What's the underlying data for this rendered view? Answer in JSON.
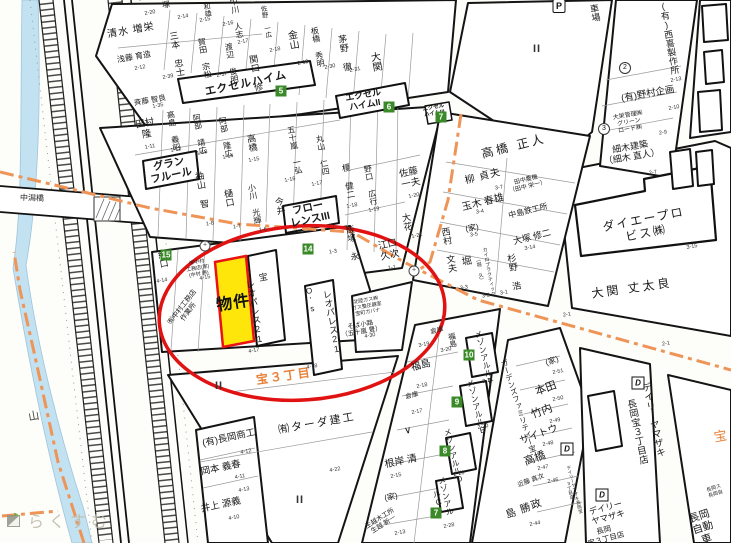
{
  "map": {
    "colors": {
      "highlight_fill": "#ffe60a",
      "highlight_stroke": "#e81313",
      "circle_red": "#e11212",
      "boundary_orange": "#ef9457",
      "district_orange": "#e8823a",
      "water_blue": "#c2e2f2",
      "building_number_green": "#3a8a28",
      "watermark_gray": "#bdb9a9"
    },
    "watermark": {
      "text": "らくすむ"
    },
    "bridge": {
      "label": "中潟橋"
    },
    "highlight": {
      "label": "物件"
    },
    "name_labels": [
      {
        "t": "塚",
        "x": 166,
        "y": 5,
        "s": 8
      },
      {
        "t": "和雄",
        "x": 207,
        "y": 10,
        "s": 7,
        "v": 1
      },
      {
        "t": "中川 人志",
        "x": 236,
        "y": 18,
        "s": 8,
        "v": 1
      },
      {
        "t": "佐野 一広",
        "x": 264,
        "y": 22,
        "s": 6.5,
        "v": 1
      },
      {
        "t": "清水 増栄",
        "x": 131,
        "y": 31,
        "s": 10,
        "ls": 1
      },
      {
        "t": "浅藤 育造",
        "x": 134,
        "y": 57,
        "s": 8
      },
      {
        "t": "三本 忠士",
        "x": 176,
        "y": 54,
        "s": 9,
        "v": 1
      },
      {
        "t": "賀田 宗松",
        "x": 204,
        "y": 58,
        "s": 8,
        "v": 1
      },
      {
        "t": "渡辺 俊明",
        "x": 231,
        "y": 63,
        "s": 8,
        "v": 1
      },
      {
        "t": "関口 修",
        "x": 255,
        "y": 73,
        "s": 9,
        "v": 1
      },
      {
        "t": "金山",
        "x": 291,
        "y": 40,
        "s": 10,
        "v": 1
      },
      {
        "t": "板橋 秀明",
        "x": 317,
        "y": 47,
        "s": 8,
        "v": 1
      },
      {
        "t": "茅野 徹",
        "x": 344,
        "y": 53,
        "s": 9,
        "v": 1
      },
      {
        "t": "大関",
        "x": 374,
        "y": 62,
        "s": 10,
        "v": 1
      },
      {
        "t": "エクセルハイム",
        "x": 246,
        "y": 84,
        "r": -12,
        "s": 11,
        "b": 1,
        "ls": 1
      },
      {
        "t": "エクセル\nハイムII",
        "x": 364,
        "y": 100,
        "s": 9,
        "b": 1
      },
      {
        "t": "エクセル\nハイムIII",
        "x": 434,
        "y": 111,
        "s": 5.5,
        "b": 1
      },
      {
        "t": "車場",
        "x": 594,
        "y": 13,
        "s": 9,
        "v": 1
      },
      {
        "t": "(有)西喜製作所",
        "x": 668,
        "y": 38,
        "s": 9,
        "v": 1
      },
      {
        "t": "(有)野村企画",
        "x": 648,
        "y": 95,
        "s": 9.5
      },
      {
        "t": "大栄管理㈱\nグリーン\nロード㈱",
        "x": 629,
        "y": 123,
        "s": 6
      },
      {
        "t": "細木建築\n（細木 直人）",
        "x": 631,
        "y": 152,
        "s": 9
      },
      {
        "t": "高橋 正人",
        "x": 514,
        "y": 147,
        "r": -14,
        "s": 12,
        "ls": 3
      },
      {
        "t": "柳 貞夫",
        "x": 483,
        "y": 177,
        "r": -14,
        "s": 10,
        "ls": 1
      },
      {
        "t": "田中農機\n（田中 栄一）",
        "x": 527,
        "y": 184,
        "r": -14,
        "s": 6
      },
      {
        "t": "玉木 春雄",
        "x": 483,
        "y": 203,
        "r": -14,
        "s": 10
      },
      {
        "t": "中島鉄工所",
        "x": 528,
        "y": 211,
        "r": -14,
        "s": 8
      },
      {
        "t": "(家)",
        "x": 472,
        "y": 228,
        "s": 8
      },
      {
        "t": "大塚 修二",
        "x": 532,
        "y": 237,
        "r": -14,
        "s": 9
      },
      {
        "t": "堀",
        "x": 467,
        "y": 262,
        "s": 10
      },
      {
        "t": "カイロプラクティック",
        "x": 488,
        "y": 272,
        "s": 5,
        "v": 1
      },
      {
        "t": "（堀 久）",
        "x": 479,
        "y": 270,
        "s": 5,
        "v": 1
      },
      {
        "t": "杉野 浩",
        "x": 513,
        "y": 272,
        "s": 9,
        "v": 1
      },
      {
        "t": "西村 文夫",
        "x": 448,
        "y": 250,
        "s": 9,
        "v": 1
      },
      {
        "t": "ダイエープロビス㈱",
        "x": 645,
        "y": 227,
        "r": -11,
        "s": 12,
        "ls": 2
      },
      {
        "t": "大関 丈太良",
        "x": 632,
        "y": 289,
        "r": -8,
        "s": 12,
        "ls": 3
      },
      {
        "t": "斉藤 智良",
        "x": 150,
        "y": 101,
        "s": 7.5
      },
      {
        "t": "田村\n隆",
        "x": 146,
        "y": 130,
        "s": 9.5
      },
      {
        "t": "高島 義昭",
        "x": 173,
        "y": 131,
        "s": 8,
        "v": 1
      },
      {
        "t": "阿部 靖広",
        "x": 199,
        "y": 134,
        "s": 8,
        "v": 1
      },
      {
        "t": "阿部 隆広",
        "x": 225,
        "y": 137,
        "s": 8,
        "v": 1
      },
      {
        "t": "高橋",
        "x": 251,
        "y": 143,
        "s": 9,
        "v": 1
      },
      {
        "t": "五十嵐 一弘",
        "x": 294,
        "y": 150,
        "s": 8,
        "v": 1
      },
      {
        "t": "丸山 仁四",
        "x": 322,
        "y": 155,
        "s": 8,
        "v": 1
      },
      {
        "t": "榎 健二",
        "x": 348,
        "y": 181,
        "s": 8.5,
        "v": 1
      },
      {
        "t": "袖山 智",
        "x": 201,
        "y": 190,
        "s": 9,
        "v": 1
      },
      {
        "t": "樋口",
        "x": 228,
        "y": 198,
        "s": 9,
        "v": 1
      },
      {
        "t": "小川 光輝",
        "x": 254,
        "y": 204,
        "s": 8,
        "v": 1
      },
      {
        "t": "今井",
        "x": 279,
        "y": 206,
        "s": 9,
        "v": 1
      },
      {
        "t": "グラン\nフルール",
        "x": 170,
        "y": 170,
        "r": -12,
        "s": 10.5,
        "b": 1
      },
      {
        "t": "フロー\nレンスIII",
        "x": 309,
        "y": 214,
        "r": -12,
        "s": 10.5,
        "b": 1
      },
      {
        "t": "野口 広行",
        "x": 370,
        "y": 185,
        "s": 8,
        "v": 1
      },
      {
        "t": "佐藤\n一夫",
        "x": 410,
        "y": 179,
        "r": -12,
        "s": 9.5
      },
      {
        "t": "大花",
        "x": 406,
        "y": 222,
        "s": 9,
        "v": 1
      },
      {
        "t": "飯塚 永",
        "x": 352,
        "y": 243,
        "s": 8.5,
        "v": 1
      },
      {
        "t": "江口\n久次",
        "x": 389,
        "y": 251,
        "r": -12,
        "s": 9.5
      },
      {
        "t": "紀口",
        "x": 162,
        "y": 259,
        "s": 9,
        "v": 1
      },
      {
        "t": "㈲中村\n工務店(家)\n(中村 勝)",
        "x": 198,
        "y": 269,
        "s": 5
      },
      {
        "t": "㈲中村工務店\n作業所",
        "x": 186,
        "y": 310,
        "r": -52,
        "s": 7
      },
      {
        "t": "宝",
        "x": 262,
        "y": 277,
        "s": 9,
        "v": 1
      },
      {
        "t": "レオパレス21",
        "x": 254,
        "y": 312,
        "s": 9,
        "v": 1
      },
      {
        "t": "O's",
        "x": 310,
        "y": 300,
        "s": 8,
        "v": 1
      },
      {
        "t": "レオパレス21",
        "x": 331,
        "y": 322,
        "s": 9,
        "v": 1
      },
      {
        "t": "宝３丁目",
        "x": 284,
        "y": 377,
        "r": -8,
        "s": 12,
        "c": "#e8823a",
        "b": 1,
        "ls": 2,
        "n": "district-label"
      },
      {
        "t": "㈲ターダ建工",
        "x": 317,
        "y": 424,
        "s": 11,
        "ls": 2
      },
      {
        "t": "(有)長岡商工",
        "x": 229,
        "y": 439,
        "r": -12,
        "s": 9.5
      },
      {
        "t": "岡本 義春",
        "x": 221,
        "y": 469,
        "r": -12,
        "s": 9.5
      },
      {
        "t": "井上 源義",
        "x": 221,
        "y": 506,
        "r": -12,
        "s": 9.5
      },
      {
        "t": "北陸ガス㈱\nガス整圧器室\n宝町ガバナ",
        "x": 367,
        "y": 307,
        "s": 5
      },
      {
        "t": "そば小路\n（五十嵐 豊）",
        "x": 361,
        "y": 329,
        "s": 6.5
      },
      {
        "t": "倉庫",
        "x": 437,
        "y": 331,
        "r": -12,
        "s": 6.5
      },
      {
        "t": "福島",
        "x": 452,
        "y": 340,
        "s": 7.5,
        "v": 1
      },
      {
        "t": "福島",
        "x": 421,
        "y": 366,
        "r": -14,
        "s": 10
      },
      {
        "t": "倉庫",
        "x": 412,
        "y": 396,
        "r": -12,
        "s": 6.5
      },
      {
        "t": "∨",
        "x": 408,
        "y": 431,
        "s": 10
      },
      {
        "t": "根岸 清",
        "x": 401,
        "y": 462,
        "r": -12,
        "s": 10
      },
      {
        "t": "(家)",
        "x": 391,
        "y": 497,
        "r": -12,
        "s": 8
      },
      {
        "t": "生越木工所\n生越 新一",
        "x": 382,
        "y": 522,
        "r": -32,
        "s": 6.5
      },
      {
        "t": "メゾンアルルF",
        "x": 484,
        "y": 358,
        "r": -14,
        "s": 8,
        "v": 1
      },
      {
        "t": "メゾンアルルE",
        "x": 476,
        "y": 407,
        "r": -14,
        "s": 8,
        "v": 1
      },
      {
        "t": "メゾンアルルD",
        "x": 453,
        "y": 456,
        "r": -14,
        "s": 8,
        "v": 1
      },
      {
        "t": "メゾンアルルC",
        "x": 441,
        "y": 497,
        "r": -14,
        "s": 8,
        "v": 1
      },
      {
        "t": "ガーデンズファミリティー宝",
        "x": 518,
        "y": 406,
        "r": -18,
        "s": 7.5,
        "v": 1
      },
      {
        "t": "(家)",
        "x": 552,
        "y": 361,
        "r": -20,
        "s": 8
      },
      {
        "t": "本田",
        "x": 546,
        "y": 389,
        "r": -20,
        "s": 11
      },
      {
        "t": "竹内",
        "x": 542,
        "y": 412,
        "r": -20,
        "s": 11
      },
      {
        "t": "サイトウ",
        "x": 539,
        "y": 435,
        "r": -20,
        "s": 10
      },
      {
        "t": "高橋",
        "x": 535,
        "y": 459,
        "r": -20,
        "s": 11
      },
      {
        "t": "近藤 真次",
        "x": 531,
        "y": 481,
        "r": -20,
        "s": 6.5
      },
      {
        "t": "島 勝政",
        "x": 524,
        "y": 509,
        "r": -20,
        "s": 10.5,
        "ls": 1
      },
      {
        "t": "デイリーヤマザキ",
        "x": 652,
        "y": 420,
        "r": -12,
        "s": 9.5,
        "v": 1
      },
      {
        "t": "長岡宝３丁目店",
        "x": 636,
        "y": 432,
        "r": -12,
        "s": 9.5,
        "v": 1
      },
      {
        "t": "デイリーヤマザキ長岡宝3丁目店",
        "x": 572,
        "y": 490,
        "r": -15,
        "s": 4.5,
        "v": 1
      },
      {
        "t": "デイリー\nヤマザキ",
        "x": 607,
        "y": 513,
        "r": -15,
        "s": 8.5
      },
      {
        "t": "長岡\n宝３丁目店",
        "x": 605,
        "y": 535,
        "r": -15,
        "s": 7.5
      },
      {
        "t": "長岡自動車",
        "x": 703,
        "y": 528,
        "r": -18,
        "s": 10.5
      },
      {
        "t": "長岡ス\n長岡自",
        "x": 715,
        "y": 492,
        "r": -18,
        "s": 5
      },
      {
        "t": "宝",
        "x": 719,
        "y": 436,
        "s": 13,
        "c": "#e8823a",
        "v": 1,
        "n": "district-label"
      },
      {
        "t": "山",
        "x": 34,
        "y": 417,
        "s": 11,
        "c": "#444"
      }
    ],
    "empty_lot_marks": [
      {
        "x": 537,
        "y": 49
      },
      {
        "x": 219,
        "y": 386
      },
      {
        "x": 300,
        "y": 500
      }
    ],
    "building_numbers": [
      {
        "n": "5",
        "x": 281,
        "y": 91
      },
      {
        "n": "6",
        "x": 389,
        "y": 107
      },
      {
        "n": "7",
        "x": 441,
        "y": 117
      },
      {
        "n": "14",
        "x": 308,
        "y": 249
      },
      {
        "n": "15",
        "x": 166,
        "y": 255
      },
      {
        "n": "10",
        "x": 469,
        "y": 355
      },
      {
        "n": "9",
        "x": 457,
        "y": 402
      },
      {
        "n": "8",
        "x": 445,
        "y": 451
      },
      {
        "n": "7",
        "x": 436,
        "y": 513
      }
    ],
    "symbols": [
      {
        "k": "P",
        "t": "P",
        "x": 559,
        "y": 6,
        "n": "parking-icon"
      },
      {
        "k": "D",
        "t": "D",
        "x": 638,
        "y": 383,
        "n": "daily-yamazaki-icon"
      },
      {
        "k": "D",
        "t": "D",
        "x": 567,
        "y": 449,
        "n": "daily-yamazaki-icon"
      },
      {
        "k": "D",
        "t": "D",
        "x": 602,
        "y": 495,
        "n": "daily-yamazaki-icon"
      },
      {
        "k": "c",
        "t": "2",
        "x": 625,
        "y": 68,
        "n": "circled-number"
      },
      {
        "k": "c",
        "t": "3",
        "x": 604,
        "y": 129,
        "n": "circled-number"
      },
      {
        "k": "m",
        "t": "+",
        "x": 205,
        "y": 246,
        "n": "utility-mark"
      },
      {
        "k": "m",
        "t": "+",
        "x": 414,
        "y": 271,
        "n": "utility-mark"
      }
    ],
    "parcel_numbers": [
      {
        "n": "2-20",
        "x": 150,
        "y": 13
      },
      {
        "n": "2-14",
        "x": 183,
        "y": 17
      },
      {
        "n": "2-15",
        "x": 205,
        "y": 20
      },
      {
        "n": "2-16",
        "x": 228,
        "y": 24
      },
      {
        "n": "2-17",
        "x": 243,
        "y": 42
      },
      {
        "n": "2-18",
        "x": 275,
        "y": 50
      },
      {
        "n": "2-19",
        "x": 303,
        "y": 63
      },
      {
        "n": "2-30",
        "x": 330,
        "y": 67
      },
      {
        "n": "2-31",
        "x": 355,
        "y": 70
      },
      {
        "n": "2-12",
        "x": 140,
        "y": 68
      },
      {
        "n": "2-39",
        "x": 168,
        "y": 77
      },
      {
        "n": "2-37",
        "x": 222,
        "y": 75
      },
      {
        "n": "1-35",
        "x": 158,
        "y": 106
      },
      {
        "n": "1-11",
        "x": 150,
        "y": 147
      },
      {
        "n": "1-12",
        "x": 176,
        "y": 150
      },
      {
        "n": "1-13",
        "x": 202,
        "y": 153
      },
      {
        "n": "1-14",
        "x": 228,
        "y": 157
      },
      {
        "n": "1-15",
        "x": 254,
        "y": 160
      },
      {
        "n": "1-16",
        "x": 290,
        "y": 180
      },
      {
        "n": "1-17",
        "x": 317,
        "y": 184
      },
      {
        "n": "1-18",
        "x": 352,
        "y": 206
      },
      {
        "n": "1-19",
        "x": 374,
        "y": 210
      },
      {
        "n": "1-20",
        "x": 414,
        "y": 196
      },
      {
        "n": "1-21",
        "x": 417,
        "y": 236
      },
      {
        "n": "1-1",
        "x": 392,
        "y": 268
      },
      {
        "n": "1-3",
        "x": 333,
        "y": 252
      },
      {
        "n": "1-6",
        "x": 263,
        "y": 230
      },
      {
        "n": "1-7",
        "x": 237,
        "y": 227
      },
      {
        "n": "1-8",
        "x": 210,
        "y": 224
      },
      {
        "n": "4-14",
        "x": 162,
        "y": 281
      },
      {
        "n": "4-15",
        "x": 205,
        "y": 278
      },
      {
        "n": "4-17",
        "x": 254,
        "y": 351
      },
      {
        "n": "4-18",
        "x": 312,
        "y": 367
      },
      {
        "n": "4-30",
        "x": 370,
        "y": 336
      },
      {
        "n": "4-22",
        "x": 335,
        "y": 470
      },
      {
        "n": "4-12",
        "x": 246,
        "y": 452
      },
      {
        "n": "4-11",
        "x": 240,
        "y": 477
      },
      {
        "n": "4-13",
        "x": 244,
        "y": 490
      },
      {
        "n": "4-10",
        "x": 234,
        "y": 518
      },
      {
        "n": "2-13",
        "x": 676,
        "y": 80
      },
      {
        "n": "2-10",
        "x": 674,
        "y": 108
      },
      {
        "n": "2-9",
        "x": 663,
        "y": 133
      },
      {
        "n": "2-7",
        "x": 653,
        "y": 173
      },
      {
        "n": "3-15",
        "x": 692,
        "y": 247
      },
      {
        "n": "2-1",
        "x": 567,
        "y": 315
      },
      {
        "n": "3-7",
        "x": 499,
        "y": 188
      },
      {
        "n": "3-4",
        "x": 480,
        "y": 212
      },
      {
        "n": "3-5",
        "x": 474,
        "y": 235
      },
      {
        "n": "3-14",
        "x": 530,
        "y": 248
      },
      {
        "n": "3-3",
        "x": 464,
        "y": 288
      },
      {
        "n": "3-2",
        "x": 486,
        "y": 296
      },
      {
        "n": "3-1",
        "x": 504,
        "y": 293
      },
      {
        "n": "3-19",
        "x": 424,
        "y": 345
      },
      {
        "n": "3-20",
        "x": 446,
        "y": 350
      },
      {
        "n": "2-21",
        "x": 488,
        "y": 381
      },
      {
        "n": "2-20",
        "x": 483,
        "y": 427
      },
      {
        "n": "2-26",
        "x": 459,
        "y": 474
      },
      {
        "n": "2-28",
        "x": 449,
        "y": 526
      },
      {
        "n": "2-17",
        "x": 417,
        "y": 412
      },
      {
        "n": "2-18",
        "x": 422,
        "y": 386
      },
      {
        "n": "2-15",
        "x": 396,
        "y": 476
      },
      {
        "n": "2-13",
        "x": 400,
        "y": 533
      },
      {
        "n": "2-51",
        "x": 558,
        "y": 372
      },
      {
        "n": "2-50",
        "x": 558,
        "y": 399
      },
      {
        "n": "2-49",
        "x": 555,
        "y": 421
      },
      {
        "n": "2-48",
        "x": 548,
        "y": 444
      },
      {
        "n": "2-47",
        "x": 543,
        "y": 468
      },
      {
        "n": "2-46",
        "x": 553,
        "y": 481
      },
      {
        "n": "2-44",
        "x": 535,
        "y": 524
      },
      {
        "n": "2-1",
        "x": 666,
        "y": 344
      }
    ]
  }
}
